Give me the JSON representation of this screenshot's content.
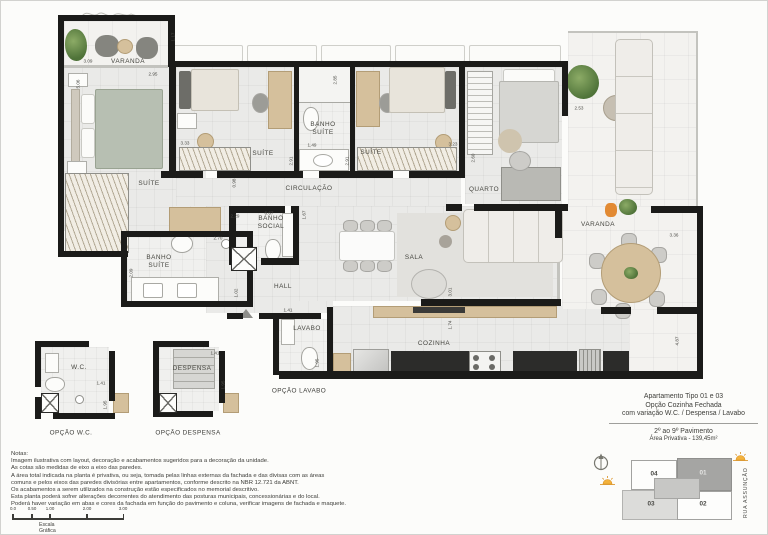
{
  "plan": {
    "rooms": {
      "varanda_left": "VARANDA",
      "suite_master": "SUÍTE",
      "suite_2": "SUÍTE",
      "suite_3": "SUÍTE",
      "banho_suite_top": "BANHO\nSUÍTE",
      "banho_suite_master": "BANHO\nSUÍTE",
      "circulacao": "CIRCULAÇÃO",
      "quarto": "QUARTO",
      "varanda_right": "VARANDA",
      "banho_social": "BANHO\nSOCIAL",
      "hall": "HALL",
      "sala": "SALA",
      "lavabo": "LAVABO",
      "cozinha": "COZINHA",
      "wc": "W.C.",
      "despensa": "DESPENSA"
    },
    "captions": {
      "opcao_wc": "OPÇÃO W.C.",
      "opcao_despensa": "OPÇÃO DESPENSA",
      "opcao_lavabo": "OPÇÃO LAVABO"
    },
    "dims": {
      "d117": "1.17",
      "d309": "3.09",
      "d295": "2.95",
      "d506": "5.06",
      "d333": "3.33",
      "d149": "1.49",
      "d291a": "2.91",
      "d291b": "2.91",
      "d285": "2.85",
      "d323": "3.23",
      "d260": "2.60",
      "d253": "2.53",
      "d336": "3.36",
      "d098": "0.98",
      "d229": "2.29",
      "d667": "6.67",
      "d167": "1.67",
      "d270": "2.70",
      "d209": "2.09",
      "d102": "1.02",
      "d141_lavabo": "1.41",
      "d195_lavabo": "1.95",
      "d301": "3.01",
      "d174": "1.74",
      "d487": "4.87",
      "d141_wc": "1.41",
      "d195_wc": "1.95",
      "d141_despensa": "1.41",
      "d195_despensa": "1.95"
    }
  },
  "title_block": {
    "line1": "Apartamento Tipo 01 e 03",
    "line2": "Opção Cozinha Fechada",
    "line3": "com variação W.C. / Despensa / Lavabo",
    "pavimento": "2º ao 9º Pavimento",
    "area": "Área Privativa - 139,45m²"
  },
  "key_plan": {
    "units": {
      "u01": "01",
      "u02": "02",
      "u03": "03",
      "u04": "04"
    },
    "street": "RUA ASSUNÇÃO",
    "highlight_color": "#a5a5a3",
    "secondary_color": "#dcdcda",
    "sun_color": "#f0a62e"
  },
  "notes": {
    "title": "Notas:",
    "lines": [
      "Imagem ilustrativa com layout, decoração e acabamentos sugeridos para a decoração da unidade.",
      "As cotas são medidas de eixo a eixo das paredes.",
      "A área total indicada na planta é privativa, ou seja, tomada pelas linhas externas da fachada e das divisas com as áreas",
      "comuns e pelos eixos das paredes divisórias entre apartamentos, conforme descrito na NBR 12.721 da ABNT.",
      "Os acabamentos a serem utilizados na construção estão especificados no memorial descritivo.",
      "Esta planta poderá sofrer alterações decorrentes do atendimento das posturas municipais, concessionárias e do local.",
      "Poderá haver variação em abas e cores da fachada em função do pavimento e coluna, verificar imagens de fachada e maquete."
    ]
  },
  "scale_bar": {
    "ticks": [
      "0.0",
      "0.50",
      "1.00",
      "2.00",
      "3.00"
    ],
    "label": "Escala Gráfica"
  }
}
